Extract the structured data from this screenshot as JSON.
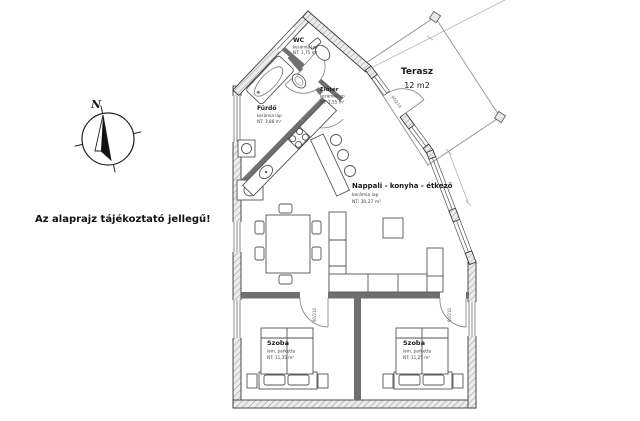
{
  "disclaimer": "Az alaprajz tájékoztató jellegű!",
  "compass": {
    "north": "N"
  },
  "rooms": {
    "wc": {
      "name": "WC",
      "floor": "kerámia lap",
      "area": "NT: 1,75 m²"
    },
    "furdo": {
      "name": "Fürdő",
      "floor": "kerámia lap",
      "area": "NT: 3,88 m²"
    },
    "eloter": {
      "name": "Előtér",
      "floor": "kerámia lap",
      "area": "NT: 2,55 m²"
    },
    "nappali": {
      "name": "Nappali - konyha - étkező",
      "floor": "kerámia lap",
      "area": "NT: 30,27 m²"
    },
    "terasz": {
      "name": "Terasz",
      "area": "12 m2"
    },
    "szoba_left": {
      "name": "Szoba",
      "floor": "lam. parketta",
      "area": "NT: 11,35 m²"
    },
    "szoba_right": {
      "name": "Szoba",
      "floor": "lam. parketta",
      "area": "NT: 11,25 m²"
    }
  },
  "doors": {
    "bedroom_left": "90/210",
    "bedroom_right": "90/210",
    "entry": "90/210"
  },
  "colors": {
    "wall_outline": "#3a3a3a",
    "wall_hatch_fill": "#ececec",
    "wall_hatch_line": "#9f9f9f",
    "interior_wall": "#6f6f6f",
    "furniture_line": "#555555",
    "terrace_line": "#999999",
    "label_text": "#1a1a1a"
  }
}
